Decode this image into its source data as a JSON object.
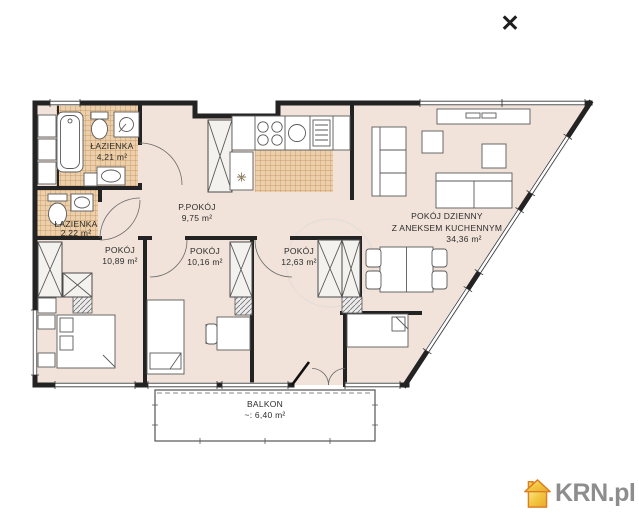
{
  "icons": {
    "close": "✕"
  },
  "logo": {
    "text": "KRN.pl",
    "house_color": "#f2c63f",
    "house_outline": "#dc7e22"
  },
  "plan": {
    "colors": {
      "floor": "#f1e3d9",
      "tile": "#ecd0ab",
      "tile_grid": "#c08b52",
      "wall": "#232323"
    },
    "rooms": [
      {
        "name": "ŁAZIENKA",
        "area": "4,21 m²"
      },
      {
        "name": "ŁAZIENKA",
        "area": "2,22 m²"
      },
      {
        "name": "P.POKÓJ",
        "area": "9,75 m²"
      },
      {
        "name": "POKÓJ",
        "area": "10,89 m²"
      },
      {
        "name": "POKÓJ",
        "area": "10,16 m²"
      },
      {
        "name": "POKÓJ",
        "area": "12,63 m²"
      },
      {
        "name": "POKÓJ DZIENNY",
        "name2": "Z ANEKSEM KUCHENNYM",
        "area": "34,36 m²"
      },
      {
        "name": "BALKON",
        "area": "~: 6,40 m²"
      }
    ]
  }
}
